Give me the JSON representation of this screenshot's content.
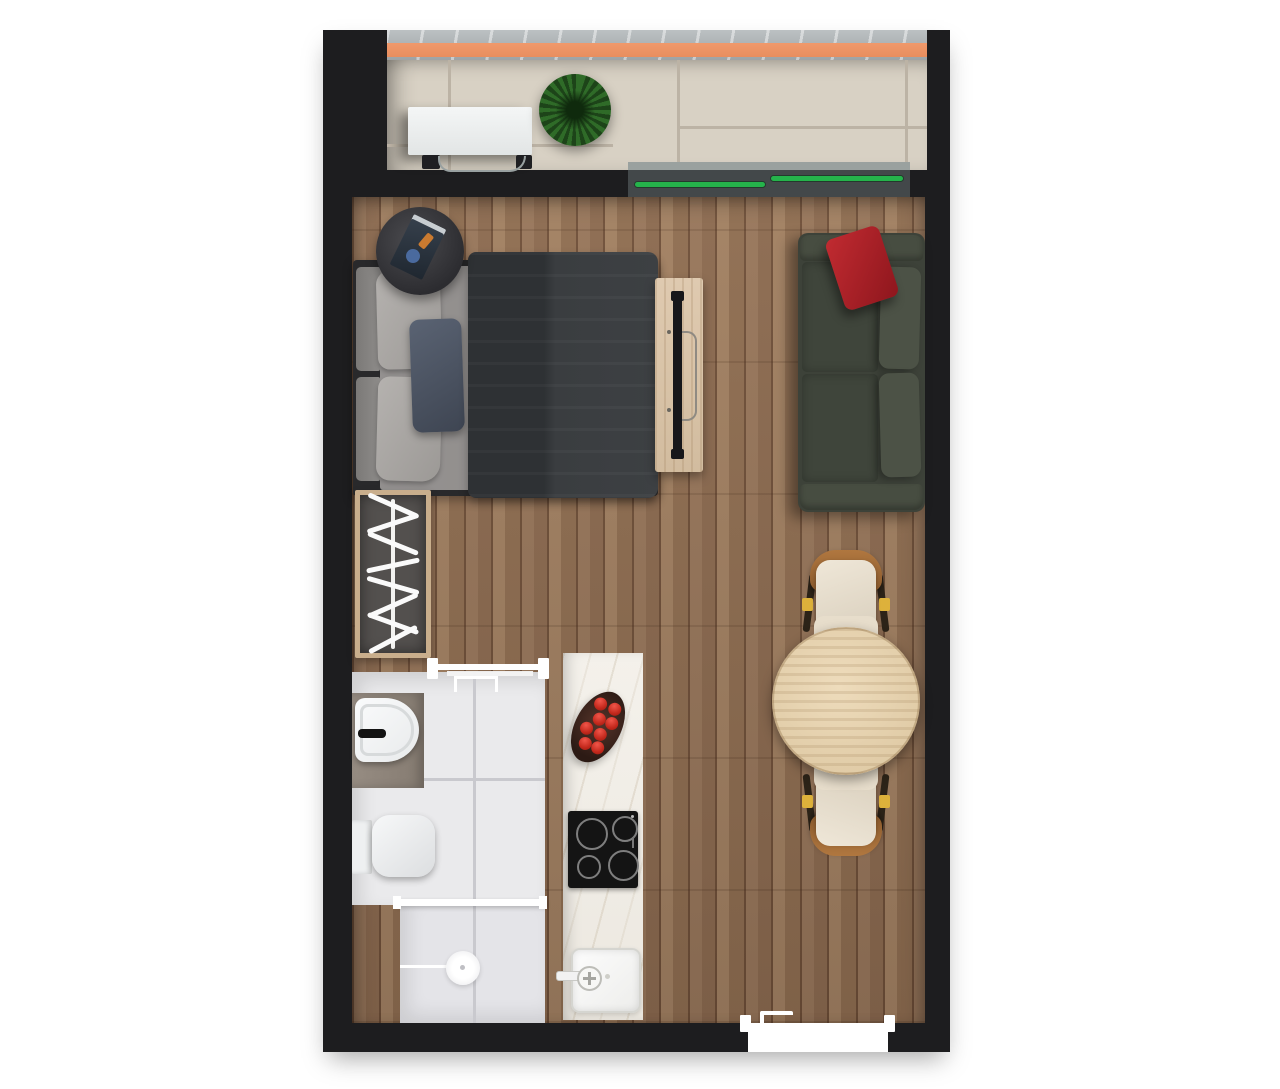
{
  "scene": {
    "kind": "studio-apartment-floor-plan-top-down-render",
    "rooms": [
      "balcony",
      "living-sleeping-area",
      "bathroom",
      "kitchenette",
      "entry"
    ],
    "objects": [
      "balcony-ac-unit",
      "potted-plant",
      "sliding-window-green-glass",
      "double-bed",
      "gray-pillows",
      "navy-accent-pillow",
      "charcoal-duvet",
      "round-nightstand",
      "tv-console",
      "flat-tv-panel",
      "dark-green-sofa",
      "red-throw-pillow",
      "open-wardrobe-with-hangers",
      "round-dining-table",
      "dining-chair-top",
      "dining-chair-bottom",
      "bathroom-sink",
      "black-faucet",
      "toilet",
      "shower-with-drain",
      "shower-glass-divider",
      "kitchen-counter",
      "tomato-bowl",
      "induction-cooktop",
      "kitchen-sink",
      "bathroom-door",
      "entry-door"
    ]
  },
  "palette": {
    "background": "#ffffff",
    "wall": "#1d1d1f",
    "accent_orange": "#f0996b",
    "window_green": "#25b34b",
    "balcony_tile": "#d8d1c4",
    "bathroom_tile": "#eaeaec",
    "kitchen_marble": "#f4f1eb",
    "counter_taupe": "#968c82",
    "sofa_green": "#3d4239",
    "pillow_red": "#8e161d",
    "duvet_charcoal": "#3d4043",
    "pillow_navy": "#3e4552",
    "table_wood": "#e0cba6",
    "chair_brown": "#8a5a2d",
    "accent_yellow": "#ddb13b",
    "tomato_red": "#c3281c",
    "plant_green": "#2f6b28",
    "console_wood": "#d2bc9f",
    "wardrobe_frame": "#c9ae8c",
    "cooktop_black": "#141414"
  }
}
